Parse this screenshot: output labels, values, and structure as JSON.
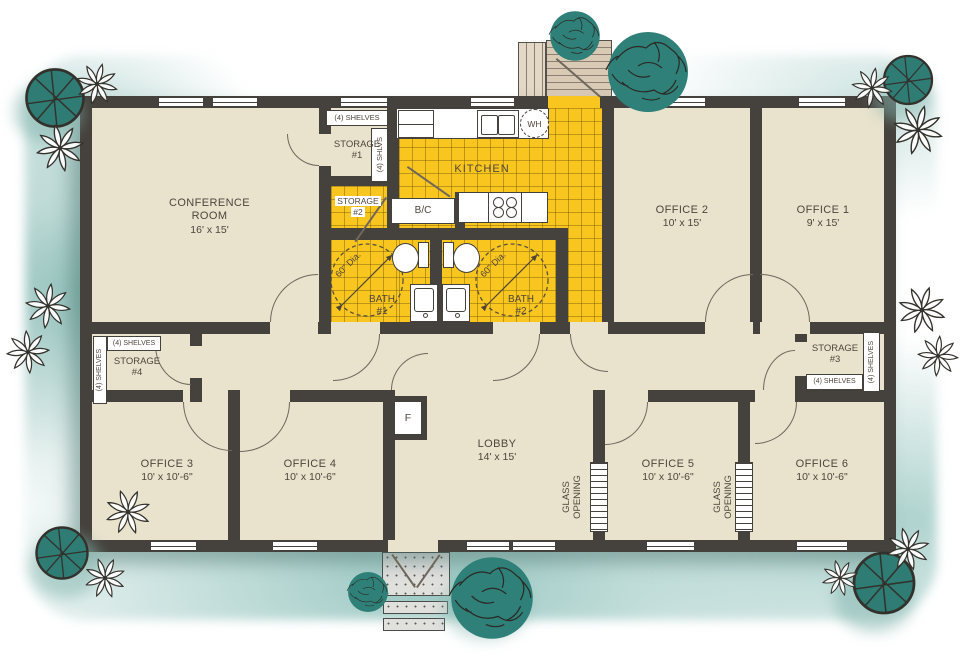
{
  "rooms": {
    "conference": {
      "name": "CONFERENCE ROOM",
      "dims": "16' x 15'"
    },
    "kitchen": {
      "name": "KITCHEN"
    },
    "lobby": {
      "name": "LOBBY",
      "dims": "14' x 15'"
    },
    "office1": {
      "name": "OFFICE 1",
      "dims": "9' x 15'"
    },
    "office2": {
      "name": "OFFICE 2",
      "dims": "10' x 15'"
    },
    "office3": {
      "name": "OFFICE 3",
      "dims": "10' x 10'-6\""
    },
    "office4": {
      "name": "OFFICE 4",
      "dims": "10' x 10'-6\""
    },
    "office5": {
      "name": "OFFICE 5",
      "dims": "10' x 10'-6\""
    },
    "office6": {
      "name": "OFFICE 6",
      "dims": "10' x 10'-6\""
    },
    "bath1": {
      "name": "BATH",
      "number": "#1",
      "clearance": "60\" Dia."
    },
    "bath2": {
      "name": "BATH",
      "number": "#2",
      "clearance": "60\" Dia."
    },
    "storage1": {
      "name": "STORAGE",
      "number": "#1"
    },
    "storage2": {
      "name": "STORAGE",
      "number": "#2"
    },
    "storage3": {
      "name": "STORAGE",
      "number": "#3"
    },
    "storage4": {
      "name": "STORAGE",
      "number": "#4"
    }
  },
  "fixtures": {
    "opt_dw_line1": "OPT.",
    "opt_dw_line2": "DW",
    "water_heater": "WH",
    "broom_closet": "B/C",
    "furnace": "F"
  },
  "annotations": {
    "shelves": "(4) SHELVES",
    "shelves_abbr": "(4) SHLVS",
    "glass_line1": "GLASS",
    "glass_line2": "OPENING"
  },
  "colors": {
    "wall": "#45413c",
    "floor": "#e9e2cc",
    "tile_yellow": "#f9c51f",
    "tree_teal": "#2e7c74",
    "ground_wash": "#a8cbc6"
  }
}
